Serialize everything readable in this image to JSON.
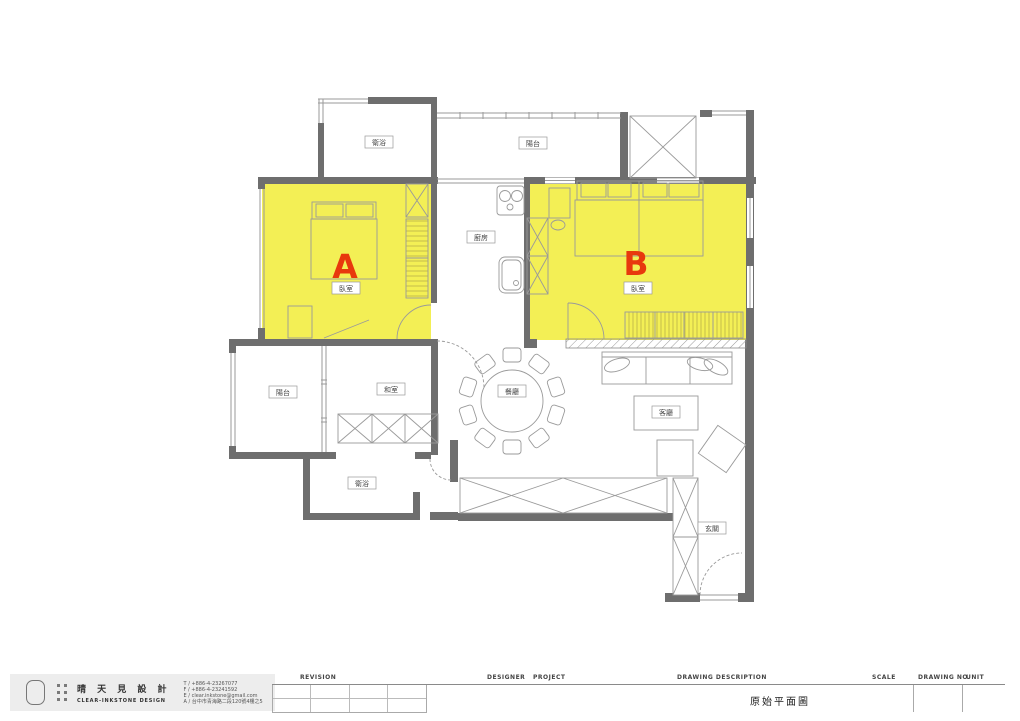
{
  "plan": {
    "highlight_color": "#f3ef55",
    "letter_color": "#e8380d",
    "wall_color": "#6e6e6e",
    "room_a": {
      "letter": "A",
      "label": "臥室"
    },
    "room_b": {
      "letter": "B",
      "label": "臥室"
    },
    "labels": {
      "bath_top": "衛浴",
      "balcony_top": "陽台",
      "kitchen": "廚房",
      "balcony_left": "陽台",
      "tatami": "和室",
      "dining": "餐廳",
      "living": "客廳",
      "bath_bottom": "衛浴",
      "entry": "玄關"
    }
  },
  "title_block": {
    "company_cn": "晴 天 見 設 計",
    "company_en": "CLEAR-INKSTONE DESIGN",
    "contact": [
      "T / +886-4-23267077",
      "F / +886-4-23241592",
      "E / clear.inkstone@gmail.com",
      "A / 台中市青海路二段120號4樓之5"
    ],
    "revision": "REVISION",
    "designer": "DESIGNER",
    "project": "PROJECT",
    "drawing_description": "DRAWING DESCRIPTION",
    "drawing_name": "原始平面圖",
    "scale": "SCALE",
    "drawing_no": "DRAWING NO.",
    "unit": "UNIT"
  }
}
